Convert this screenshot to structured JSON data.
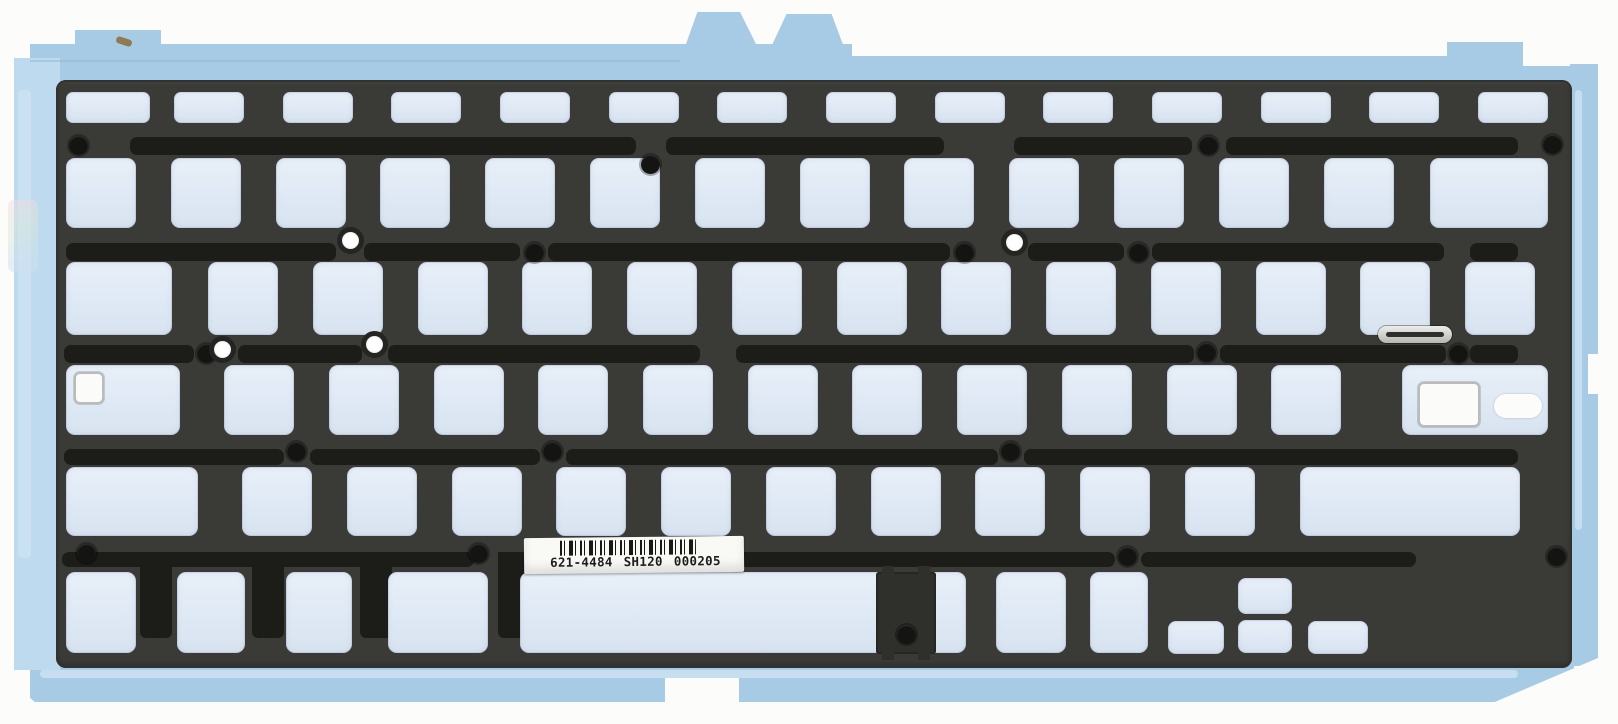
{
  "label": {
    "part_number": "621-4484",
    "code": "SH120",
    "serial": "000205",
    "full_text": "621-4484 SH120 000205"
  },
  "colors": {
    "background": "#fcfcfa",
    "sheet_blue": "#a7cbe5",
    "sheet_pale_blue": "#bddaee",
    "sheet_highlight": "#cde2f2",
    "panel_dark": "#3a3a37",
    "channel_black": "#1c1c19",
    "cutout_fill": "#dfe9f5",
    "hole_black": "#141412",
    "label_white": "#f9f9f6",
    "metal_silver": "#c6c6c2"
  },
  "layout": {
    "canvas": {
      "w": 1618,
      "h": 724
    },
    "sheet_pieces": [
      {
        "x": 30,
        "y": 44,
        "w": 822,
        "h": 42
      },
      {
        "x": 850,
        "y": 56,
        "w": 614,
        "h": 30
      },
      {
        "x": 1462,
        "y": 66,
        "w": 112,
        "h": 20
      },
      {
        "x": 14,
        "y": 58,
        "w": 46,
        "h": 612,
        "cls": "sheet-pale"
      },
      {
        "x": 1570,
        "y": 64,
        "w": 28,
        "h": 602
      },
      {
        "x": 30,
        "y": 662,
        "w": 1502,
        "h": 40
      },
      {
        "x": 1528,
        "y": 660,
        "w": 46,
        "h": 30
      },
      {
        "x": 75,
        "y": 30,
        "w": 86,
        "h": 18,
        "name": "top-left-tab"
      },
      {
        "x": 681,
        "y": 12,
        "w": 82,
        "h": 46,
        "clip": "20% 0,72% 0,100% 100%,0 100%",
        "name": "top-center-tab-1"
      },
      {
        "x": 766,
        "y": 14,
        "w": 82,
        "h": 44,
        "clip": "25% 0,80% 0,100% 100%,0 100%",
        "name": "top-center-tab-2"
      },
      {
        "x": 1447,
        "y": 42,
        "w": 76,
        "h": 26,
        "name": "top-right-tab"
      }
    ],
    "sheet_details": [
      {
        "cls": "sheet-light",
        "x": 18,
        "y": 90,
        "w": 13,
        "h": 468
      },
      {
        "cls": "sheet-light",
        "x": 40,
        "y": 670,
        "w": 1478,
        "h": 8
      },
      {
        "cls": "sheet-light",
        "x": 1575,
        "y": 90,
        "w": 7,
        "h": 440
      },
      {
        "cls": "iridescent",
        "x": 8,
        "y": 200,
        "w": 30,
        "h": 72
      },
      {
        "cls": "seam",
        "x": 30,
        "y": 60,
        "w": 650,
        "h": 2
      },
      {
        "cls": "speck",
        "x": 116,
        "y": 38,
        "w": 16,
        "h": 7
      }
    ],
    "notches": [
      {
        "x": 0,
        "y": 290,
        "w": 14,
        "h": 44
      },
      {
        "x": 0,
        "y": 556,
        "w": 12,
        "h": 46
      },
      {
        "x": 665,
        "y": 678,
        "w": 74,
        "h": 26
      },
      {
        "x": 1588,
        "y": 354,
        "w": 12,
        "h": 40
      },
      {
        "x": 14,
        "y": 684,
        "w": 22,
        "h": 19,
        "clip": "0 0,0 100%,100% 100%"
      },
      {
        "x": 1490,
        "y": 658,
        "w": 108,
        "h": 46,
        "clip": "100% 0,100% 100%,0 100%"
      }
    ],
    "panel": {
      "x": 56,
      "y": 80,
      "w": 1516,
      "h": 588,
      "r": 10
    },
    "channels": [
      {
        "y": 137,
        "h": 18,
        "segments": [
          [
            130,
            636
          ],
          [
            666,
            944
          ],
          [
            1014,
            1192
          ],
          [
            1226,
            1518
          ]
        ]
      },
      {
        "y": 243,
        "h": 18,
        "segments": [
          [
            66,
            336
          ],
          [
            364,
            520
          ],
          [
            548,
            950
          ],
          [
            1028,
            1124
          ],
          [
            1152,
            1444
          ],
          [
            1470,
            1518
          ]
        ]
      },
      {
        "y": 345,
        "h": 18,
        "segments": [
          [
            64,
            194
          ],
          [
            238,
            362
          ],
          [
            388,
            700
          ],
          [
            736,
            1194
          ],
          [
            1220,
            1446
          ],
          [
            1470,
            1518
          ]
        ]
      },
      {
        "y": 449,
        "h": 16,
        "segments": [
          [
            64,
            284
          ],
          [
            310,
            540
          ],
          [
            566,
            998
          ],
          [
            1024,
            1518
          ]
        ]
      },
      {
        "y": 552,
        "h": 15,
        "segments": [
          [
            62,
            474
          ],
          [
            500,
            1115
          ],
          [
            1141,
            1416
          ]
        ]
      }
    ],
    "channel_drops": [
      {
        "x": 140,
        "y": 552,
        "w": 32,
        "h": 86
      },
      {
        "x": 252,
        "y": 552,
        "w": 32,
        "h": 86
      },
      {
        "x": 360,
        "y": 552,
        "w": 32,
        "h": 86
      },
      {
        "x": 498,
        "y": 552,
        "w": 30,
        "h": 86
      }
    ],
    "rows": [
      {
        "name": "function-row",
        "y": 92,
        "h": 31,
        "r": 7,
        "keys": [
          {
            "n": "esc",
            "x": 66,
            "w": 84
          },
          {
            "n": "f1",
            "x": 174,
            "w": 70
          },
          {
            "n": "f2",
            "x": 283,
            "w": 70
          },
          {
            "n": "f3",
            "x": 391,
            "w": 70
          },
          {
            "n": "f4",
            "x": 500,
            "w": 70
          },
          {
            "n": "f5",
            "x": 609,
            "w": 70
          },
          {
            "n": "f6",
            "x": 717,
            "w": 70
          },
          {
            "n": "f7",
            "x": 826,
            "w": 70
          },
          {
            "n": "f8",
            "x": 935,
            "w": 70
          },
          {
            "n": "f9",
            "x": 1043,
            "w": 70
          },
          {
            "n": "f10",
            "x": 1152,
            "w": 70
          },
          {
            "n": "f11",
            "x": 1261,
            "w": 70
          },
          {
            "n": "f12",
            "x": 1369,
            "w": 70
          },
          {
            "n": "power",
            "x": 1478,
            "w": 70
          }
        ]
      },
      {
        "name": "number-row",
        "y": 158,
        "h": 70,
        "r": 9,
        "keys": [
          {
            "n": "grave",
            "x": 66,
            "w": 70
          },
          {
            "n": "digit-1",
            "x": 171,
            "w": 70
          },
          {
            "n": "digit-2",
            "x": 276,
            "w": 70
          },
          {
            "n": "digit-3",
            "x": 380,
            "w": 70
          },
          {
            "n": "digit-4",
            "x": 485,
            "w": 70
          },
          {
            "n": "digit-5",
            "x": 590,
            "w": 70
          },
          {
            "n": "digit-6",
            "x": 695,
            "w": 70
          },
          {
            "n": "digit-7",
            "x": 800,
            "w": 70
          },
          {
            "n": "digit-8",
            "x": 904,
            "w": 70
          },
          {
            "n": "digit-9",
            "x": 1009,
            "w": 70
          },
          {
            "n": "digit-0",
            "x": 1114,
            "w": 70
          },
          {
            "n": "minus",
            "x": 1219,
            "w": 70
          },
          {
            "n": "equals",
            "x": 1324,
            "w": 70
          },
          {
            "n": "delete",
            "x": 1430,
            "w": 118
          }
        ]
      },
      {
        "name": "qwerty-row",
        "y": 262,
        "h": 73,
        "r": 9,
        "keys": [
          {
            "n": "tab",
            "x": 66,
            "w": 106
          },
          {
            "n": "q",
            "x": 208,
            "w": 70
          },
          {
            "n": "w",
            "x": 313,
            "w": 70
          },
          {
            "n": "e",
            "x": 418,
            "w": 70
          },
          {
            "n": "r",
            "x": 522,
            "w": 70
          },
          {
            "n": "t",
            "x": 627,
            "w": 70
          },
          {
            "n": "y",
            "x": 732,
            "w": 70
          },
          {
            "n": "u",
            "x": 837,
            "w": 70
          },
          {
            "n": "i",
            "x": 941,
            "w": 70
          },
          {
            "n": "o",
            "x": 1046,
            "w": 70
          },
          {
            "n": "p",
            "x": 1151,
            "w": 70
          },
          {
            "n": "bracket-left",
            "x": 1256,
            "w": 70
          },
          {
            "n": "bracket-right",
            "x": 1360,
            "w": 70
          },
          {
            "n": "backslash",
            "x": 1465,
            "w": 70
          }
        ]
      },
      {
        "name": "home-row",
        "y": 365,
        "h": 70,
        "r": 9,
        "keys": [
          {
            "n": "caps-lock",
            "x": 66,
            "w": 114
          },
          {
            "n": "a",
            "x": 224,
            "w": 70
          },
          {
            "n": "s",
            "x": 329,
            "w": 70
          },
          {
            "n": "d",
            "x": 434,
            "w": 70
          },
          {
            "n": "f",
            "x": 538,
            "w": 70
          },
          {
            "n": "g",
            "x": 643,
            "w": 70
          },
          {
            "n": "h",
            "x": 748,
            "w": 70
          },
          {
            "n": "j",
            "x": 852,
            "w": 70
          },
          {
            "n": "k",
            "x": 957,
            "w": 70
          },
          {
            "n": "l",
            "x": 1062,
            "w": 70
          },
          {
            "n": "semicolon",
            "x": 1167,
            "w": 70
          },
          {
            "n": "quote",
            "x": 1271,
            "w": 70
          },
          {
            "n": "return",
            "x": 1402,
            "w": 146
          }
        ]
      },
      {
        "name": "shift-row",
        "y": 467,
        "h": 69,
        "r": 9,
        "keys": [
          {
            "n": "shift-left",
            "x": 66,
            "w": 132
          },
          {
            "n": "z",
            "x": 242,
            "w": 70
          },
          {
            "n": "x",
            "x": 347,
            "w": 70
          },
          {
            "n": "c",
            "x": 452,
            "w": 70
          },
          {
            "n": "v",
            "x": 556,
            "w": 70
          },
          {
            "n": "b",
            "x": 661,
            "w": 70
          },
          {
            "n": "n",
            "x": 766,
            "w": 70
          },
          {
            "n": "m",
            "x": 871,
            "w": 70
          },
          {
            "n": "comma",
            "x": 975,
            "w": 70
          },
          {
            "n": "period",
            "x": 1080,
            "w": 70
          },
          {
            "n": "slash",
            "x": 1185,
            "w": 70
          },
          {
            "n": "shift-right",
            "x": 1300,
            "w": 220
          }
        ]
      },
      {
        "name": "bottom-row",
        "y": 572,
        "h": 81,
        "r": 9,
        "keys": [
          {
            "n": "fn",
            "x": 66,
            "w": 70
          },
          {
            "n": "control",
            "x": 177,
            "w": 68
          },
          {
            "n": "option",
            "x": 286,
            "w": 66
          },
          {
            "n": "command",
            "x": 388,
            "w": 100
          },
          {
            "n": "space",
            "x": 520,
            "w": 446
          },
          {
            "n": "command-right",
            "x": 996,
            "w": 70
          },
          {
            "n": "option-right",
            "x": 1090,
            "w": 58
          },
          {
            "n": "arrow-left",
            "x": 1168,
            "w": 56,
            "y": 621,
            "h": 33,
            "r": 8
          },
          {
            "n": "arrow-up",
            "x": 1238,
            "w": 54,
            "y": 578,
            "h": 36,
            "r": 8
          },
          {
            "n": "arrow-down",
            "x": 1238,
            "w": 54,
            "y": 620,
            "h": 33,
            "r": 8
          },
          {
            "n": "arrow-right",
            "x": 1308,
            "w": 60,
            "y": 621,
            "h": 33,
            "r": 8
          }
        ]
      }
    ],
    "features": {
      "caps_lock_indicator_window": {
        "x": 74,
        "y": 372,
        "w": 30,
        "h": 32
      },
      "return_insert_window": {
        "x": 1418,
        "y": 382,
        "w": 62,
        "h": 45
      },
      "return_insert_capsule": {
        "x": 1494,
        "y": 394,
        "w": 48,
        "h": 24
      },
      "metal_slot": {
        "x": 1378,
        "y": 326,
        "w": 74,
        "h": 17
      },
      "metal_slot_line": {
        "x": 1386,
        "y": 332,
        "w": 58,
        "h": 5
      },
      "space_inset_block": {
        "x": 876,
        "y": 572,
        "w": 60,
        "h": 82
      },
      "space_inset_nubs": [
        {
          "x": 882,
          "y": 566,
          "w": 12,
          "h": 8
        },
        {
          "x": 918,
          "y": 566,
          "w": 12,
          "h": 8
        },
        {
          "x": 882,
          "y": 651,
          "w": 12,
          "h": 9
        },
        {
          "x": 918,
          "y": 651,
          "w": 12,
          "h": 9
        }
      ]
    },
    "holes_dark": [
      [
        78,
        145
      ],
      [
        1208,
        145
      ],
      [
        1552,
        144
      ],
      [
        650,
        164
      ],
      [
        534,
        252
      ],
      [
        964,
        252
      ],
      [
        1138,
        252
      ],
      [
        206,
        353
      ],
      [
        1206,
        352
      ],
      [
        1458,
        353
      ],
      [
        296,
        451
      ],
      [
        552,
        451
      ],
      [
        1010,
        451
      ],
      [
        86,
        553
      ],
      [
        478,
        553
      ],
      [
        1127,
        556
      ],
      [
        1556,
        556
      ],
      [
        906,
        634
      ]
    ],
    "holes_light": [
      [
        350,
        240
      ],
      [
        1014,
        242
      ],
      [
        222,
        349
      ],
      [
        374,
        344
      ]
    ],
    "label": {
      "x": 524,
      "y": 537,
      "w": 220,
      "h": 36
    }
  }
}
